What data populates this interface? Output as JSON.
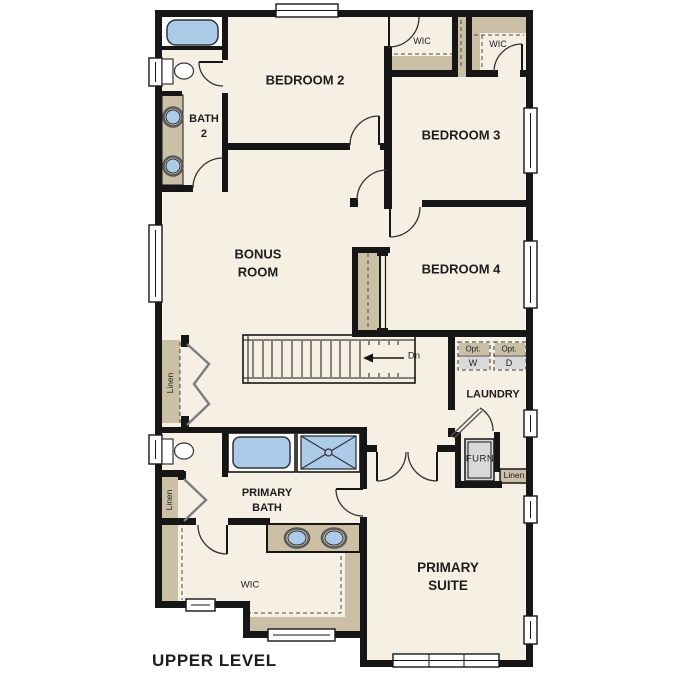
{
  "title": "UPPER LEVEL",
  "rooms": {
    "bedroom2": "BEDROOM 2",
    "bedroom3": "BEDROOM 3",
    "bedroom4": "BEDROOM 4",
    "bonus_line1": "BONUS",
    "bonus_line2": "ROOM",
    "bath2_line1": "BATH",
    "bath2_line2": "2",
    "primary_bath_line1": "PRIMARY",
    "primary_bath_line2": "BATH",
    "primary_suite_line1": "PRIMARY",
    "primary_suite_line2": "SUITE",
    "laundry": "LAUNDRY",
    "wic_bedroom2": "WIC",
    "wic_bedroom3": "WIC",
    "wic_primary": "WIC",
    "furnace": "FURN",
    "linen_hall": "Linen",
    "linen_bath": "Linen",
    "linen_laundry": "Linen"
  },
  "annotations": {
    "stairs_direction": "Dn",
    "washer_opt": "Opt.",
    "washer": "W",
    "dryer_opt": "Opt.",
    "dryer": "D"
  },
  "colors": {
    "floor": "#f6efe3",
    "wall": "#161616",
    "casework_tan": "#cbc0a6",
    "fixture_blue": "#abcbe8",
    "appliance_gray": "#d9d9d9",
    "outline": "#333333"
  }
}
